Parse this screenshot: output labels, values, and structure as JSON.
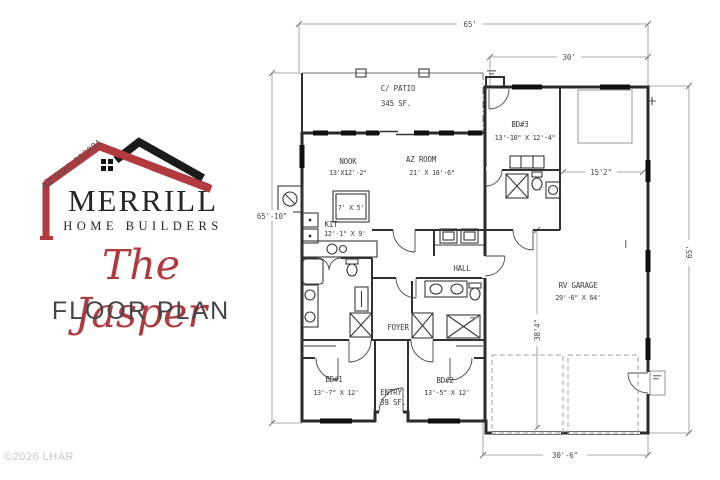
{
  "branding": {
    "license": "AZ ROC 333831",
    "company_name": "MERRILL",
    "company_subtitle": "HOME BUILDERS",
    "plan_script_name": "The Jasper",
    "plan_label": "FLOOR PLAN",
    "copyright": "©2026 LHAR",
    "accent_red": "#b23a3e",
    "text_dark": "#24262a"
  },
  "floor_plan": {
    "rooms": [
      {
        "id": "patio",
        "name": "C/ PATIO",
        "area": "345 SF."
      },
      {
        "id": "nook",
        "name": "NOOK",
        "dims": "13'X12'-2\""
      },
      {
        "id": "az_room",
        "name": "AZ ROOM",
        "dims": "21' X 18'-6\""
      },
      {
        "id": "kitchen",
        "name": "KIT",
        "dims": "12'-1\" X 9'"
      },
      {
        "id": "island",
        "dims": "7' X 5'"
      },
      {
        "id": "bd3",
        "name": "BD#3",
        "dims": "13'-10\" X 12'-4\""
      },
      {
        "id": "hall",
        "name": "HALL"
      },
      {
        "id": "foyer",
        "name": "FOYER"
      },
      {
        "id": "entry",
        "name": "ENTRY",
        "area": "39 SF."
      },
      {
        "id": "bd1",
        "name": "BD#1",
        "dims": "13'-7\" X 12'"
      },
      {
        "id": "bd2",
        "name": "BD#2",
        "dims": "13'-5\" X 12'"
      },
      {
        "id": "rv_garage",
        "name": "RV GARAGE",
        "dims": "29'-6\" X 64'"
      }
    ],
    "dimensions": {
      "top_width": "65'",
      "garage_width": "30'",
      "left_height": "65'-10\"",
      "right_height": "65'",
      "garage_interior_width": "15'2\"",
      "garage_depth": "38'4\"",
      "bottom_width": "30'-6\""
    }
  }
}
